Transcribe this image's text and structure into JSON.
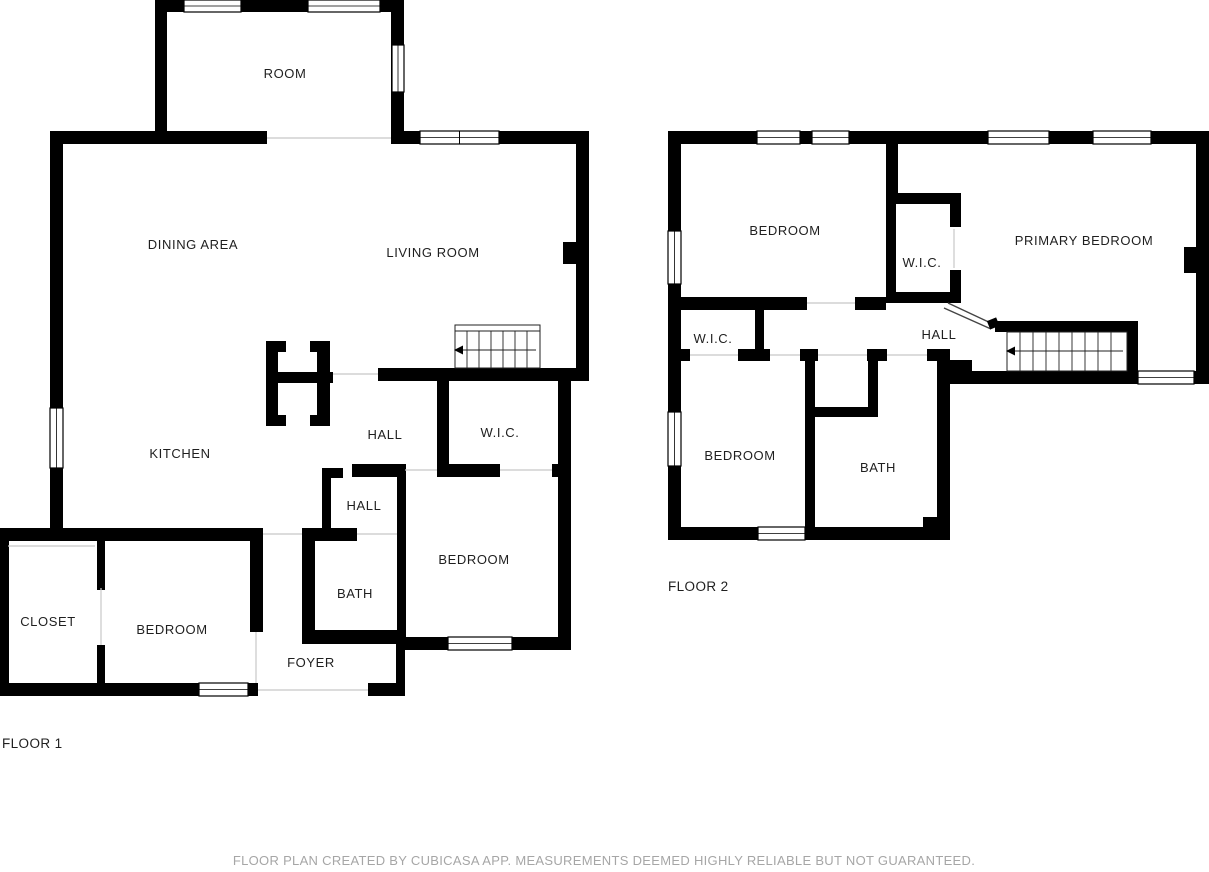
{
  "floor1": {
    "caption": "FLOOR 1",
    "rooms": {
      "room": "ROOM",
      "dining_area": "DINING AREA",
      "living_room": "LIVING ROOM",
      "kitchen": "KITCHEN",
      "hall_upper": "HALL",
      "wic": "W.I.C.",
      "hall_lower": "HALL",
      "bath": "BATH",
      "bedroom_center": "BEDROOM",
      "closet": "CLOSET",
      "bedroom_left": "BEDROOM",
      "foyer": "FOYER"
    }
  },
  "floor2": {
    "caption": "FLOOR 2",
    "rooms": {
      "bedroom_top": "BEDROOM",
      "wic_primary": "W.I.C.",
      "primary_bedroom": "PRIMARY BEDROOM",
      "wic_hall": "W.I.C.",
      "hall": "HALL",
      "bedroom_bottom": "BEDROOM",
      "bath": "BATH"
    }
  },
  "footer": {
    "disclaimer": "FLOOR PLAN CREATED BY CUBICASA APP. MEASUREMENTS DEEMED HIGHLY RELIABLE BUT NOT GUARANTEED."
  },
  "colors": {
    "wall": "#000000",
    "background": "#ffffff",
    "label": "#1f1f1f",
    "disclaimer": "#a6a6a6",
    "threshold": "#c8c8c8"
  }
}
